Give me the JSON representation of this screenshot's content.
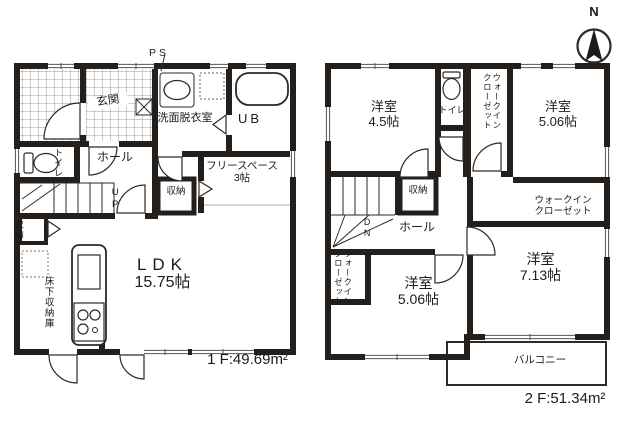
{
  "meta": {
    "wall_color": "#241f1b",
    "line_color": "#2a2a2a",
    "background": "#ffffff"
  },
  "compass": {
    "north": "N"
  },
  "floor1": {
    "area": "1 F:49.69m²",
    "labels": {
      "ps": "PS",
      "genkan": "玄関",
      "senmen": "洗面脱衣室",
      "ub": "UB",
      "toilet": "トイレ",
      "hall": "ホール",
      "up": "UP",
      "stairs_storage": "収納",
      "freespace_name": "フリースペース",
      "freespace_size": "3帖",
      "left_storage": "収納",
      "underfloor": "床下収納庫",
      "ldk_name": "LDK",
      "ldk_size": "15.75帖"
    }
  },
  "floor2": {
    "area": "2 F:51.34m²",
    "labels": {
      "room45_name": "洋室",
      "room45_size": "4.5帖",
      "toilet": "トイレ",
      "wic_top_l1": "ウォークイン",
      "wic_top_l2": "クローゼット",
      "room506tr_name": "洋室",
      "room506tr_size": "5.06帖",
      "storage": "収納",
      "dn": "DN",
      "hall": "ホール",
      "wic_left_l1": "ウォークイン",
      "wic_left_l2": "クローゼット",
      "room506bl_name": "洋室",
      "room506bl_size": "5.06帖",
      "wic_right_l1": "ウォークイン",
      "wic_right_l2": "クローゼット",
      "room713_name": "洋室",
      "room713_size": "7.13帖",
      "balcony": "バルコニー"
    }
  }
}
